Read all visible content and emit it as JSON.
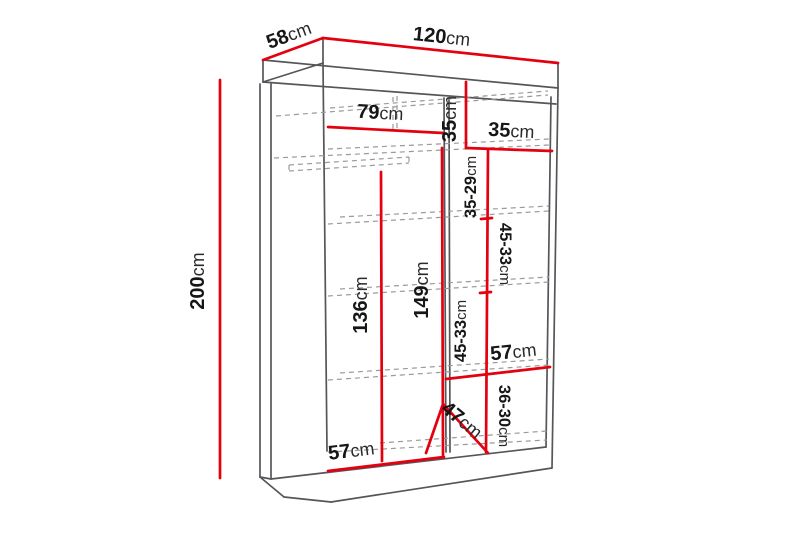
{
  "diagram": {
    "name": "Wardrobe dimension diagram",
    "unit": "cm",
    "colors": {
      "dimension_red": "#e4000f",
      "outline_gray": "#55565a",
      "hidden_gray": "#9a9a9a",
      "label_black": "#161616",
      "background": "#ffffff"
    },
    "overall": {
      "width": {
        "value": "120",
        "unit": "cm"
      },
      "depth": {
        "value": "58",
        "unit": "cm"
      },
      "height": {
        "value": "200",
        "unit": "cm"
      }
    },
    "interior": {
      "top_left_width": {
        "value": "79",
        "unit": "cm"
      },
      "top_right_height": {
        "value": "35",
        "unit": "cm"
      },
      "right_column_width": {
        "value": "35",
        "unit": "cm"
      },
      "right_gap_1": {
        "value": "35-29",
        "unit": "cm"
      },
      "right_gap_2": {
        "value": "45-33",
        "unit": "cm"
      },
      "right_gap_3": {
        "value": "45-33",
        "unit": "cm"
      },
      "left_hanging_height": {
        "value": "136",
        "unit": "cm"
      },
      "center_height": {
        "value": "149",
        "unit": "cm"
      },
      "right_shelf_width": {
        "value": "57",
        "unit": "cm"
      },
      "right_gap_4": {
        "value": "36-30",
        "unit": "cm"
      },
      "bottom_diagonal": {
        "value": "47",
        "unit": "cm"
      },
      "bottom_left_width": {
        "value": "57",
        "unit": "cm"
      }
    }
  }
}
